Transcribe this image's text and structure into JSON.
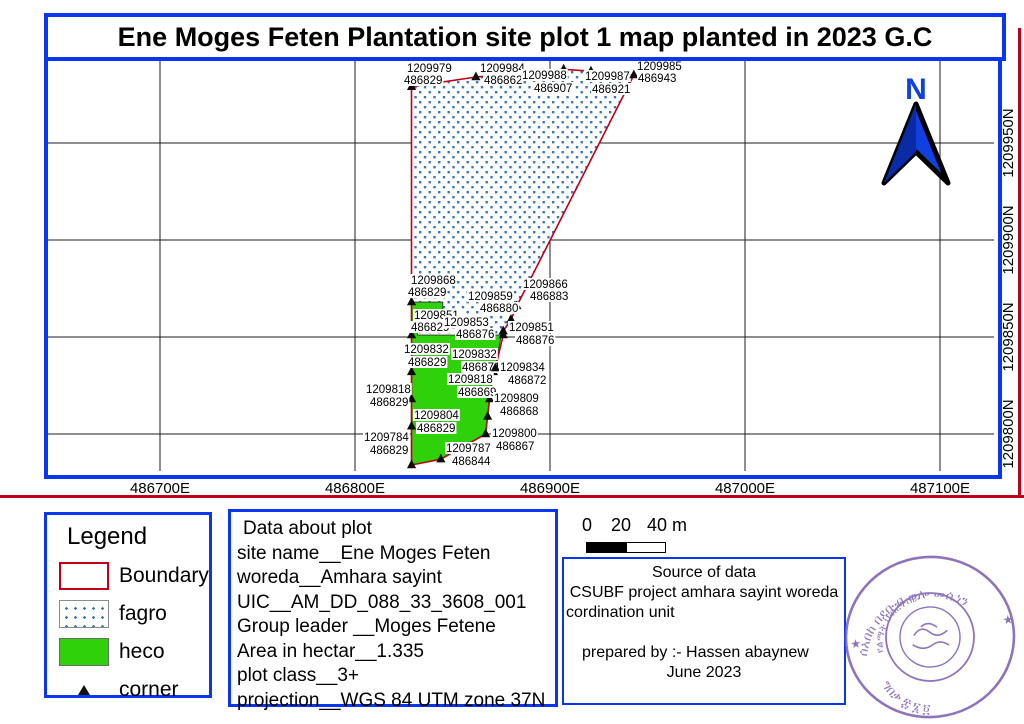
{
  "title": "Ene Moges Feten Plantation site plot 1 map planted in 2023 G.C",
  "colors": {
    "frame_blue": "#0a36f0",
    "boundary_red": "#c00018",
    "heco_green": "#2fd10a",
    "fagro_dot_blue": "#3a78b5",
    "grid_black": "#1c1c1c",
    "north_arrow_blue": "#1140e0",
    "stamp_purple": "#7a5cb0"
  },
  "map": {
    "eastings": [
      486700,
      486800,
      486900,
      487000,
      487100
    ],
    "northings": [
      1209950,
      1209900,
      1209850,
      1209800
    ],
    "easting_suffix": "E",
    "northing_suffix": "N",
    "boundary_en": [
      [
        486829,
        1209979
      ],
      [
        486862,
        1209984
      ],
      [
        486907,
        1209988
      ],
      [
        486921,
        1209987
      ],
      [
        486943,
        1209985
      ],
      [
        486883,
        1209866
      ],
      [
        486880,
        1209859
      ],
      [
        486876,
        1209853
      ],
      [
        486876,
        1209851
      ],
      [
        486872,
        1209834
      ],
      [
        486871,
        1209832
      ],
      [
        486869,
        1209818
      ],
      [
        486868,
        1209809
      ],
      [
        486867,
        1209800
      ],
      [
        486844,
        1209787
      ],
      [
        486829,
        1209784
      ],
      [
        486829,
        1209804
      ],
      [
        486829,
        1209818
      ],
      [
        486829,
        1209832
      ],
      [
        486829,
        1209851
      ],
      [
        486829,
        1209868
      ]
    ],
    "fagro_en": [
      [
        486829,
        1209979
      ],
      [
        486862,
        1209984
      ],
      [
        486907,
        1209988
      ],
      [
        486921,
        1209987
      ],
      [
        486943,
        1209985
      ],
      [
        486883,
        1209866
      ],
      [
        486880,
        1209859
      ],
      [
        486876,
        1209853
      ],
      [
        486876,
        1209851
      ],
      [
        486832,
        1209851
      ],
      [
        486832,
        1209862
      ],
      [
        486845,
        1209862
      ],
      [
        486845,
        1209868
      ],
      [
        486829,
        1209868
      ]
    ],
    "heco_en": [
      [
        486829,
        1209868
      ],
      [
        486845,
        1209868
      ],
      [
        486845,
        1209862
      ],
      [
        486832,
        1209862
      ],
      [
        486832,
        1209851
      ],
      [
        486875,
        1209851
      ],
      [
        486872,
        1209834
      ],
      [
        486871,
        1209832
      ],
      [
        486869,
        1209818
      ],
      [
        486868,
        1209809
      ],
      [
        486867,
        1209800
      ],
      [
        486844,
        1209787
      ],
      [
        486829,
        1209784
      ]
    ],
    "corner_points": [
      {
        "n": 1209979,
        "e": 486829,
        "nl": [
          407,
          72
        ],
        "el": [
          404,
          84
        ]
      },
      {
        "n": 1209984,
        "e": 486862,
        "nl": [
          480,
          72
        ],
        "el": [
          484,
          84
        ]
      },
      {
        "n": 1209988,
        "e": 486907,
        "nl": [
          522,
          79
        ],
        "el": [
          534,
          92
        ]
      },
      {
        "n": 1209987,
        "e": 486921,
        "nl": [
          585,
          80
        ],
        "el": [
          592,
          93
        ]
      },
      {
        "n": 1209985,
        "e": 486943,
        "nl": [
          637,
          70
        ],
        "el": [
          638,
          82
        ]
      },
      {
        "n": 1209866,
        "e": 486883,
        "nl": [
          523,
          288
        ],
        "el": [
          530,
          300
        ]
      },
      {
        "n": 1209868,
        "e": 486829,
        "nl": [
          411,
          284
        ],
        "el": [
          408,
          296
        ]
      },
      {
        "n": 1209859,
        "e": 486880,
        "nl": [
          468,
          300
        ],
        "el": [
          480,
          312
        ]
      },
      {
        "n": 1209851,
        "e": 486829,
        "nl": [
          414,
          319
        ],
        "el": [
          411,
          331
        ]
      },
      {
        "n": 1209853,
        "e": 486876,
        "nl": [
          444,
          326
        ],
        "el": [
          456,
          338
        ]
      },
      {
        "n": 1209851,
        "e": 486876,
        "nl": [
          509,
          331
        ],
        "el": [
          516,
          344
        ]
      },
      {
        "n": 1209832,
        "e": 486829,
        "nl": [
          404,
          353
        ],
        "el": [
          408,
          366
        ]
      },
      {
        "n": 1209832,
        "e": 486871,
        "nl": [
          452,
          358
        ],
        "el": [
          462,
          371
        ]
      },
      {
        "n": 1209834,
        "e": 486872,
        "nl": [
          500,
          371
        ],
        "el": [
          508,
          384
        ]
      },
      {
        "n": 1209818,
        "e": 486869,
        "nl": [
          448,
          383
        ],
        "el": [
          458,
          396
        ]
      },
      {
        "n": 1209818,
        "e": 486829,
        "nl": [
          366,
          393
        ],
        "el": [
          370,
          406
        ]
      },
      {
        "n": 1209809,
        "e": 486868,
        "nl": [
          494,
          402
        ],
        "el": [
          500,
          415
        ]
      },
      {
        "n": 1209804,
        "e": 486829,
        "nl": [
          414,
          419
        ],
        "el": [
          417,
          432
        ]
      },
      {
        "n": 1209800,
        "e": 486867,
        "nl": [
          492,
          437
        ],
        "el": [
          496,
          450
        ]
      },
      {
        "n": 1209784,
        "e": 486829,
        "nl": [
          364,
          441
        ],
        "el": [
          370,
          454
        ]
      },
      {
        "n": 1209787,
        "e": 486844,
        "nl": [
          446,
          452
        ],
        "el": [
          452,
          465
        ]
      }
    ]
  },
  "north_arrow": {
    "label": "N"
  },
  "legend": {
    "title": "Legend",
    "items": [
      {
        "label": "Boundary"
      },
      {
        "label": "fagro"
      },
      {
        "label": "heco"
      },
      {
        "label": "corner"
      }
    ]
  },
  "data_box": {
    "lines": [
      " Data about plot",
      "site name__Ene Moges Feten",
      "woreda__Amhara sayint",
      "UIC__AM_DD_088_33_3608_001",
      "Group leader __Moges Fetene",
      "Area in hectar__1.335",
      "plot class__3+",
      "projection__WGS 84 UTM zone 37N"
    ]
  },
  "scale_bar": {
    "tick0": "0",
    "tick1": "20",
    "tick2": "40 m"
  },
  "source_box": {
    "title": "Source of data",
    "line1": "CSUBF project amhara sayint woreda",
    "line2": "cordination unit",
    "prepared": "prepared by :- Hassen abaynew",
    "date": "June 2023"
  },
  "stamp": {
    "arc_top": "ሰአበከ በደቡብ ወሎ መሲነን",
    "arc_mid": "የልማት ህብረትስራ",
    "arc_bottom": "ግበቃ ፰ ፮ ፬",
    "star": "★"
  }
}
